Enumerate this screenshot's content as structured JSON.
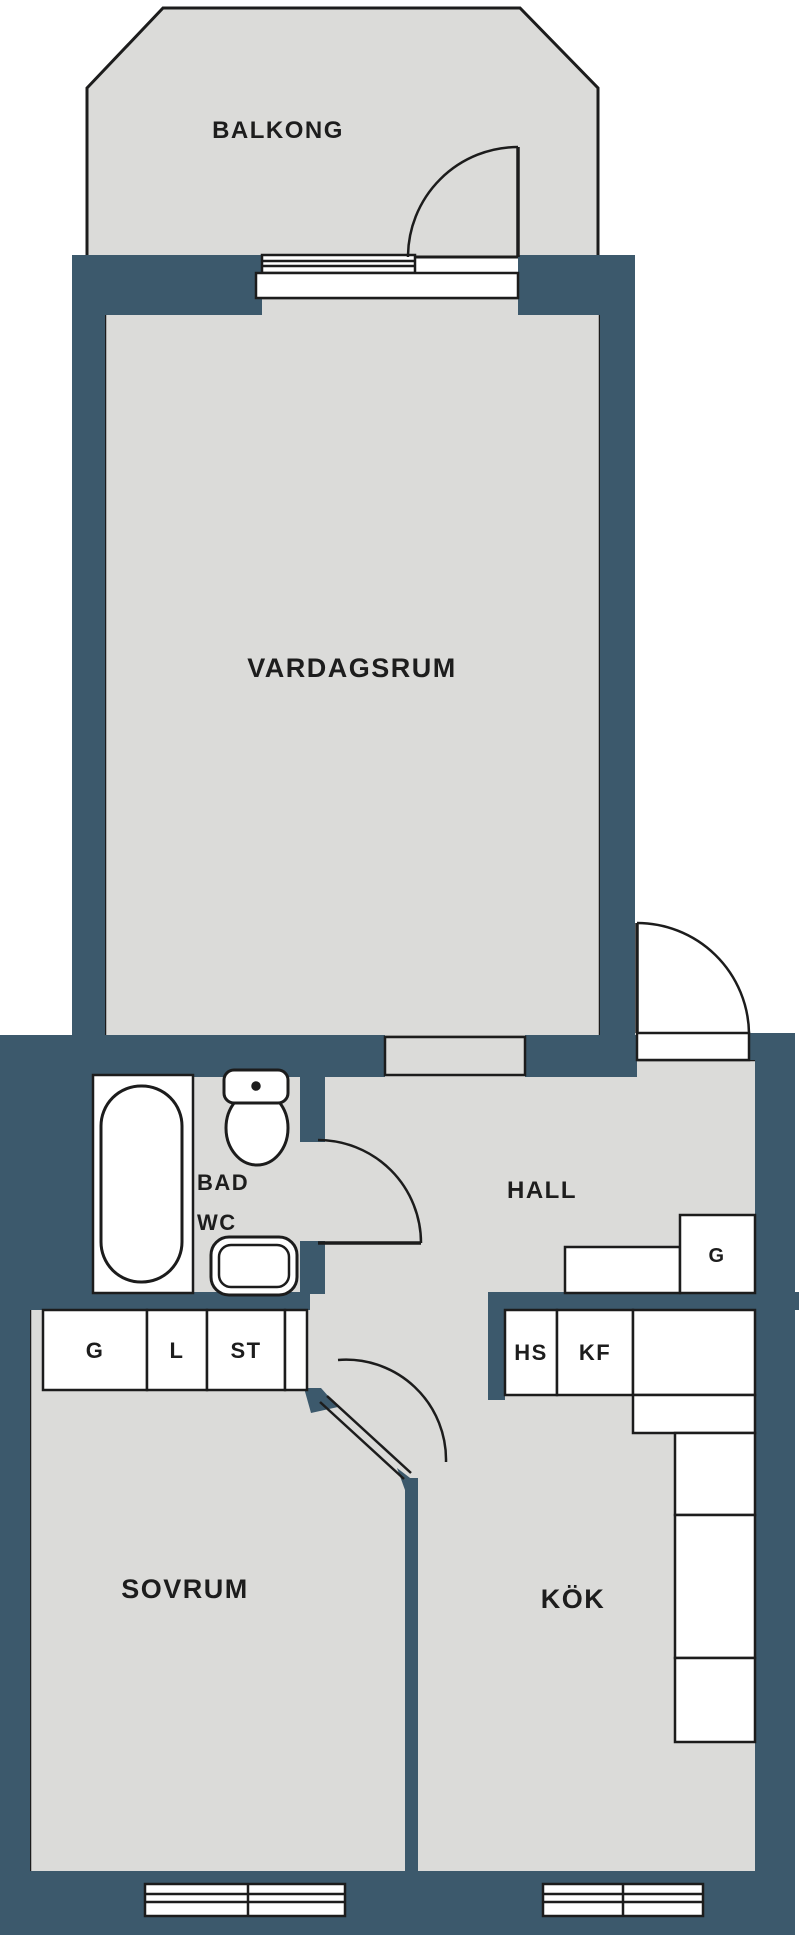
{
  "plan": {
    "type": "apartment-floor-plan",
    "language": "Swedish"
  },
  "colors": {
    "wall": "#3c596c",
    "floor": "#dbdbd9",
    "line": "#1c1c1c",
    "text": "#1d1d1d",
    "fixture": "#ffffff",
    "background": "#ffffff",
    "none": "none"
  },
  "rooms": {
    "balkong": "BALKONG",
    "vardagsrum": "VARDAGSRUM",
    "bad": "BAD",
    "wc": "WC",
    "hall": "HALL",
    "sovrum": "SOVRUM",
    "kok": "KÖK"
  },
  "storage": {
    "g_bedroom": "G",
    "l_bedroom": "L",
    "st_bedroom": "ST",
    "g_hall": "G",
    "hs_kitchen": "HS",
    "kf_kitchen": "KF"
  }
}
